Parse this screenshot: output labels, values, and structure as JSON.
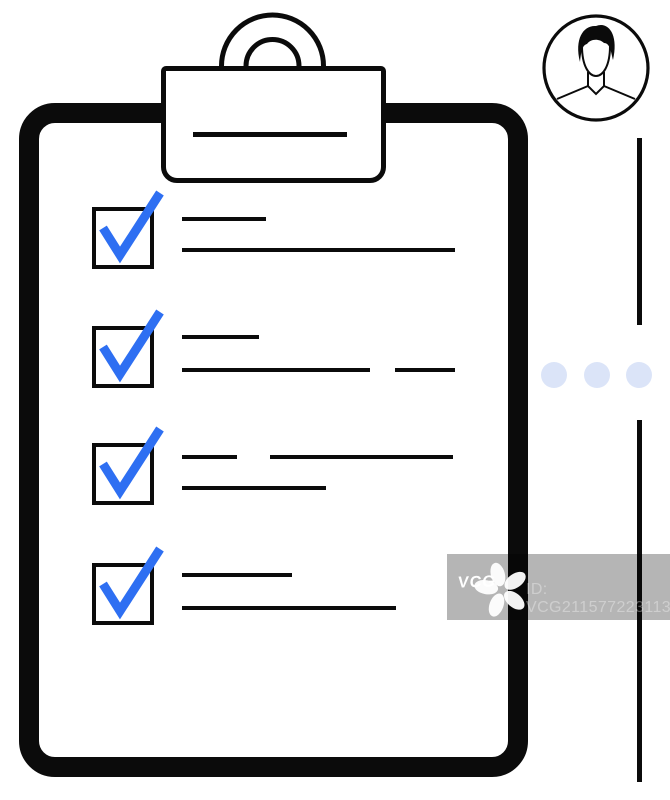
{
  "canvas": {
    "width": 670,
    "height": 800,
    "background": "#ffffff"
  },
  "colors": {
    "ink": "#0b0b0b",
    "check_blue": "#2e6ff2",
    "dot_blue": "#dbe4f8",
    "watermark_overlay": "rgba(0,0,0,0.29)",
    "watermark_text": "rgba(255,255,255,0.34)",
    "watermark_logo": "#ffffff"
  },
  "illustration": {
    "subject": "clipboard-checklist-with-avatar",
    "clipboard": {
      "clip_line": {
        "x": 193,
        "y": 132,
        "w": 154,
        "h": 5
      }
    },
    "checklist": {
      "checkbox": {
        "x": 92,
        "size": 62,
        "border": 4
      },
      "items": [
        {
          "checked": true,
          "box_y": 207,
          "segments": [
            {
              "x": 182,
              "y": 217,
              "w": 84
            },
            {
              "x": 182,
              "y": 248,
              "w": 273
            }
          ]
        },
        {
          "checked": true,
          "box_y": 326,
          "segments": [
            {
              "x": 182,
              "y": 335,
              "w": 77
            },
            {
              "x": 182,
              "y": 368,
              "w": 188
            },
            {
              "x": 395,
              "y": 368,
              "w": 60
            }
          ]
        },
        {
          "checked": true,
          "box_y": 443,
          "segments": [
            {
              "x": 182,
              "y": 455,
              "w": 55
            },
            {
              "x": 270,
              "y": 455,
              "w": 183
            },
            {
              "x": 182,
              "y": 486,
              "w": 144
            }
          ]
        },
        {
          "checked": true,
          "box_y": 563,
          "segments": [
            {
              "x": 182,
              "y": 573,
              "w": 110
            },
            {
              "x": 182,
              "y": 606,
              "w": 214
            }
          ]
        }
      ]
    },
    "avatar": {
      "cx": 596,
      "cy": 68,
      "r": 54
    },
    "divider": {
      "x": 637,
      "width": 5,
      "segments": [
        {
          "y": 138,
          "h": 187
        },
        {
          "y": 420,
          "h": 362
        }
      ]
    },
    "dots": {
      "cy": 375,
      "r": 13,
      "cx": [
        554,
        597,
        639
      ]
    }
  },
  "watermark": {
    "logo_text": "VCG",
    "id_text": "ID: VCG211577223113"
  }
}
